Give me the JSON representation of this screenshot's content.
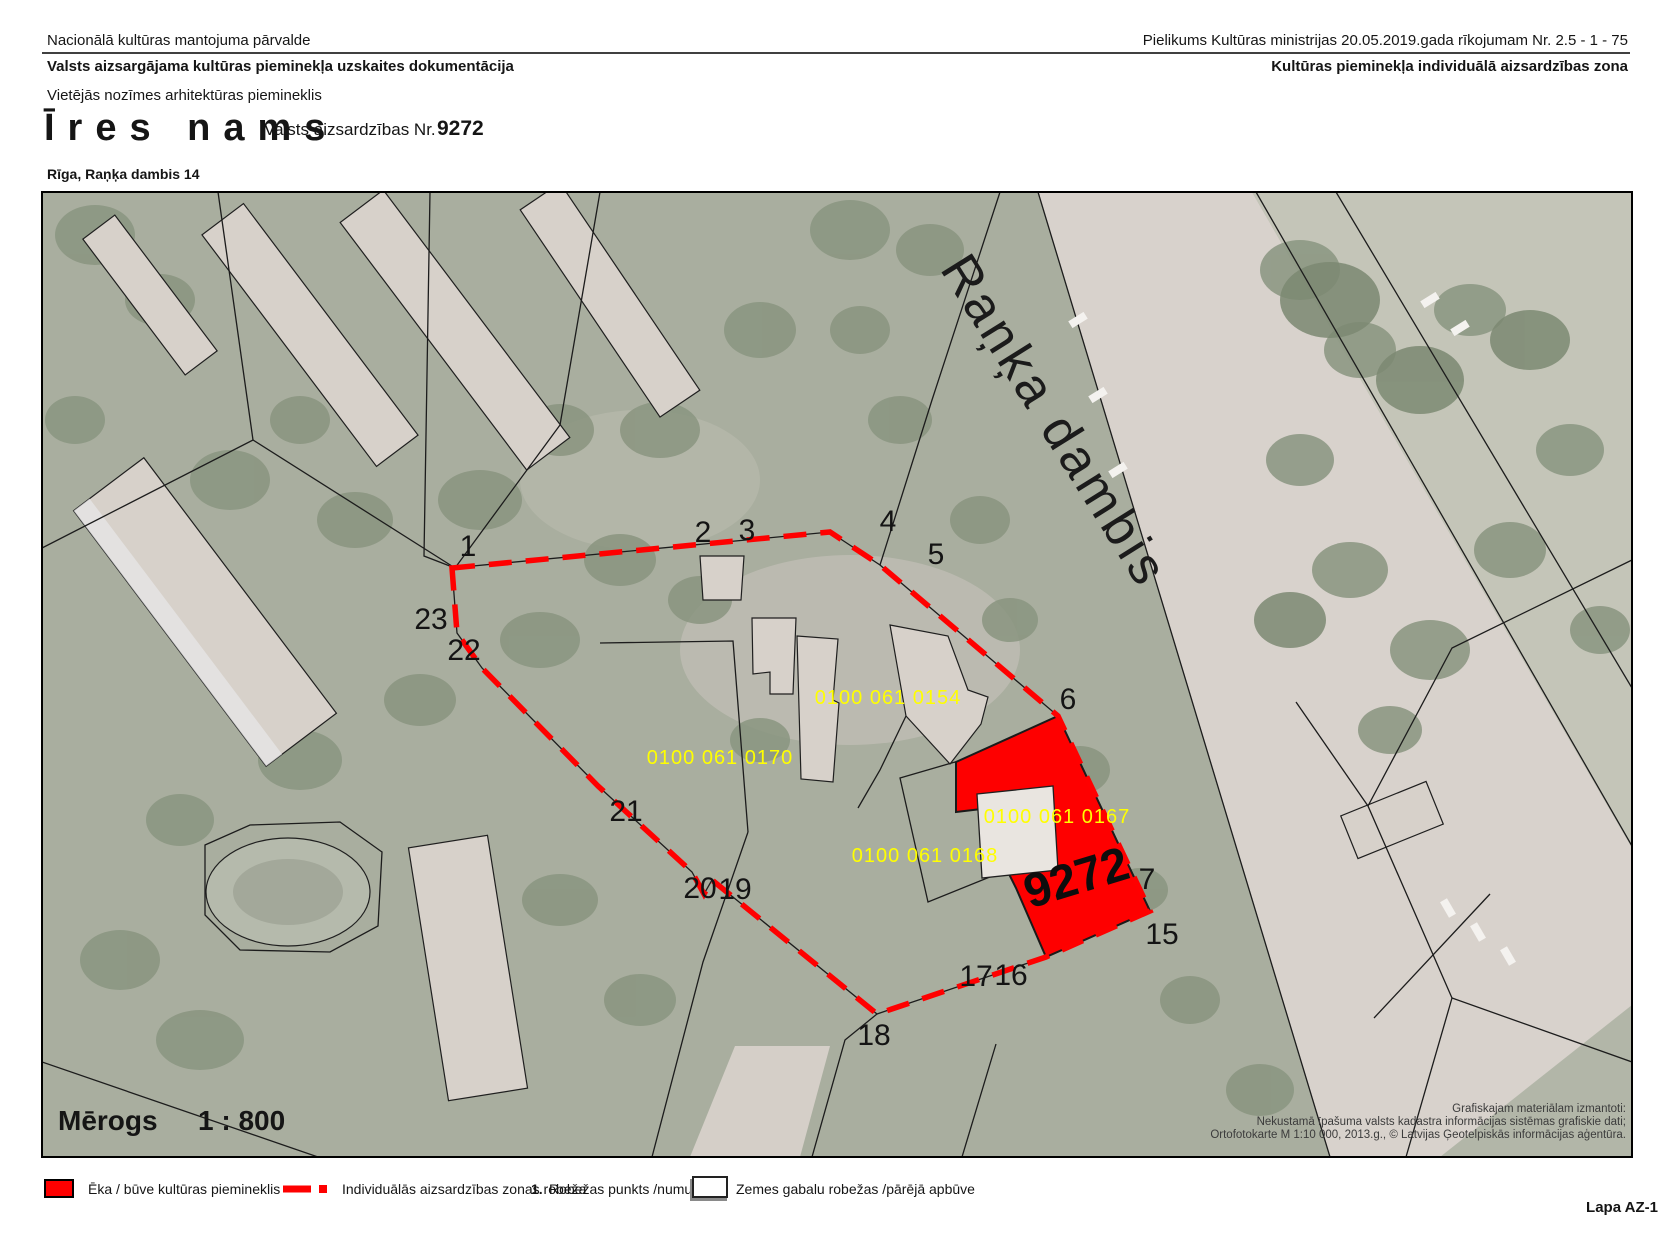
{
  "header": {
    "org": "Nacionālā kultūras mantojuma pārvalde",
    "doc_type": "Valsts aizsargājama kultūras pieminekļa uzskaites dokumentācija",
    "annex": "Pielikums Kultūras ministrijas 20.05.2019.gada  rīkojumam Nr.  2.5 - 1 - 75",
    "zone_type": "Kultūras pieminekļa individuālā aizsardzības zona",
    "monument_class": "Vietējās nozīmes arhitektūras piemineklis",
    "monument_name": "Īres nams",
    "protection_label": "Valsts aizsardzības Nr.",
    "protection_number": "9272",
    "address": "Rīga, Raņķa dambis 14"
  },
  "map": {
    "street_name": "Raņķa dambis",
    "monument_number": "9272",
    "scale": {
      "label": "Mērogs",
      "value": "1 : 800"
    },
    "cadastral_parcels": [
      "0100 061 0154",
      "0100 061 0170",
      "0100 061 0167",
      "0100 061 0168"
    ],
    "boundary_points": [
      "1",
      "2",
      "3",
      "4",
      "5",
      "6",
      "7",
      "15",
      "16",
      "17",
      "18",
      "19",
      "20",
      "21",
      "22",
      "23"
    ],
    "credits": [
      "Grafiskajam materiālam izmantoti:",
      "Nekustamā īpašuma valsts kadastra informācijas sistēmas grafiskie dati;",
      "Ortofotokarte M 1:10 000, 2013.g., © Latvijas Ģeotelpiskās informācijas aģentūra."
    ]
  },
  "legend": {
    "items": [
      {
        "swatch": "red-fill",
        "label": "Ēka / būve kultūras piemineklis"
      },
      {
        "swatch": "red-dash",
        "label": "Individuālās aizsardzības zonas robeža"
      },
      {
        "swatch": "number",
        "prefix": "1.",
        "label": "Robežas punkts /numurs"
      },
      {
        "swatch": "outline-box",
        "label": "Zemes gabalu robežas /pārējā apbūve"
      }
    ]
  },
  "footer": {
    "sheet": "Lapa AZ-1"
  },
  "colors": {
    "monument_red": "#fe0000",
    "boundary_red": "#ff0000",
    "cadastral_yellow": "#ffff00",
    "aerial_base": "#a9ae9f",
    "road_light": "#d8d2cc"
  }
}
